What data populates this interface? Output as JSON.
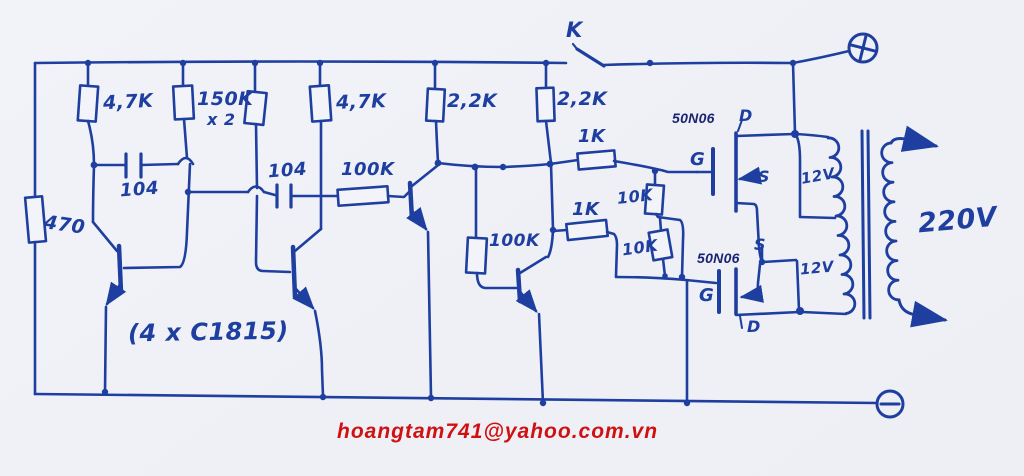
{
  "palette": {
    "paper": "#f0f1f7",
    "ink": "#1e3f9f",
    "typed_navy": "#1a2470",
    "email_red": "#d01111"
  },
  "labels": {
    "r470": "470",
    "r4k7_a": "4,7K",
    "r150k": "150K",
    "r150k_mult": "x 2",
    "r4k7_b": "4,7K",
    "r2k2_a": "2,2K",
    "r2k2_b": "2,2K",
    "cap_a": "104",
    "cap_b": "104",
    "r100k_top": "100K",
    "r100k_mid": "100K",
    "r1k_a": "1K",
    "r1k_b": "1K",
    "r10k_a": "10K",
    "r10k_b": "10K",
    "switch": "K",
    "transistors": "(4 x C1815)",
    "mosfet_a": "50N06",
    "mosfet_b": "50N06",
    "pin_d1": "D",
    "pin_g1": "G",
    "pin_s1": "S",
    "pin_s2": "S",
    "pin_g2": "G",
    "pin_d2": "D",
    "winding_a": "12V",
    "winding_b": "12V",
    "output": "220V",
    "terminal_plus": "+",
    "terminal_minus": "−"
  },
  "footer": {
    "email": "hoangtam741@yahoo.com.vn"
  }
}
